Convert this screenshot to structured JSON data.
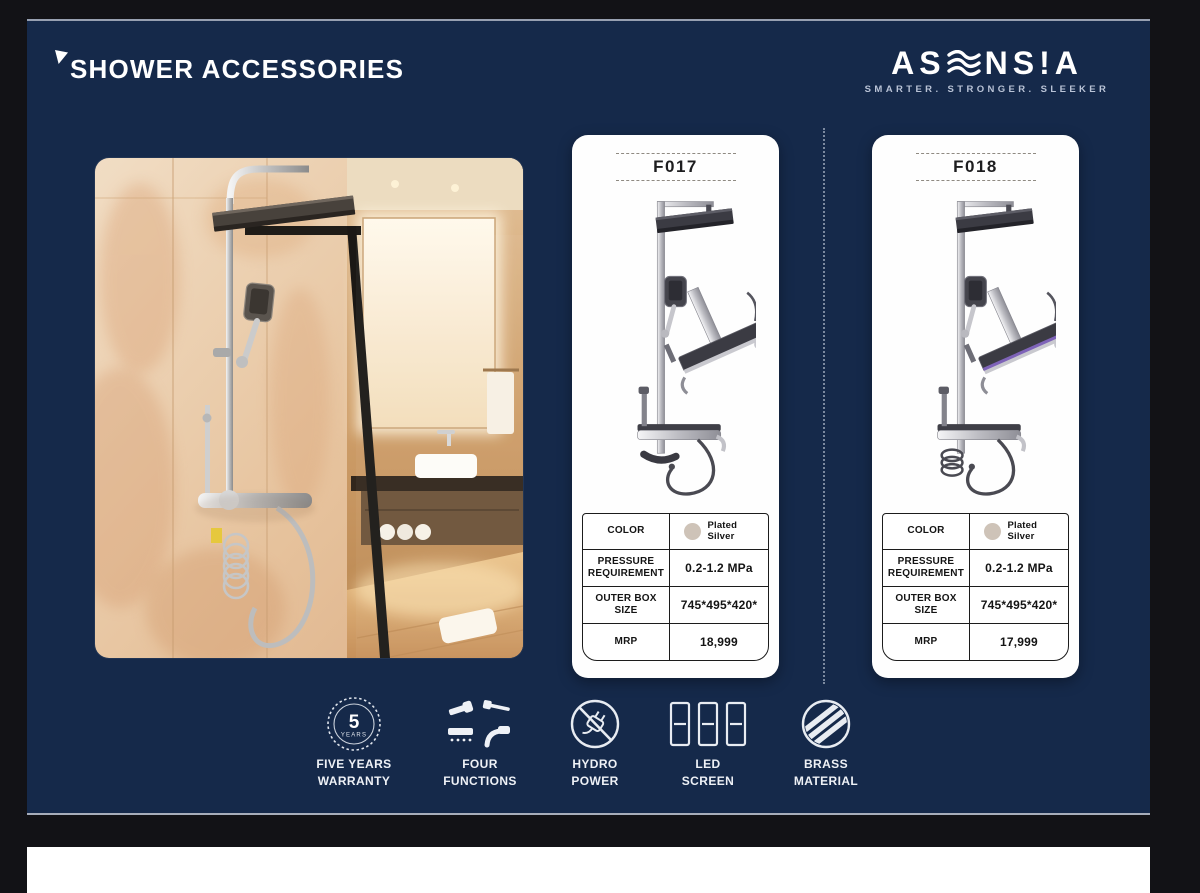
{
  "colors": {
    "canvas": "#121216",
    "slide": "#15294a",
    "card": "#fefefe",
    "swatch": "#cec3b8",
    "accent_white": "#ffffff",
    "tagline_gray": "#b9c3d6"
  },
  "header": {
    "title": "SHOWER ACCESSORIES",
    "brand_seg1": "AS",
    "brand_seg2": "NS",
    "brand_excl": "!",
    "brand_seg3": "A",
    "tagline": "SMARTER. STRONGER. SLEEKER"
  },
  "spec_labels": {
    "color": "COLOR",
    "pressure": "PRESSURE REQUIREMENT",
    "box": "OUTER BOX SIZE",
    "mrp": "MRP"
  },
  "products": [
    {
      "code": "F017",
      "color_value": "Plated Silver",
      "pressure_value": "0.2-1.2 MPa",
      "box_value": "745*495*420*",
      "mrp_value": "18,999"
    },
    {
      "code": "F018",
      "color_value": "Plated Silver",
      "pressure_value": "0.2-1.2 MPa",
      "box_value": "745*495*420*",
      "mrp_value": "17,999"
    }
  ],
  "features": [
    {
      "icon": "five-years-warranty-badge",
      "badge_number": "5",
      "badge_text": "YEARS",
      "line1": "FIVE YEARS",
      "line2": "WARRANTY"
    },
    {
      "icon": "four-functions",
      "line1": "FOUR",
      "line2": "FUNCTIONS"
    },
    {
      "icon": "hydro-power",
      "line1": "HYDRO",
      "line2": "POWER"
    },
    {
      "icon": "led-screen",
      "line1": "LED",
      "line2": "SCREEN"
    },
    {
      "icon": "brass-material",
      "line1": "BRASS",
      "line2": "MATERIAL"
    }
  ]
}
